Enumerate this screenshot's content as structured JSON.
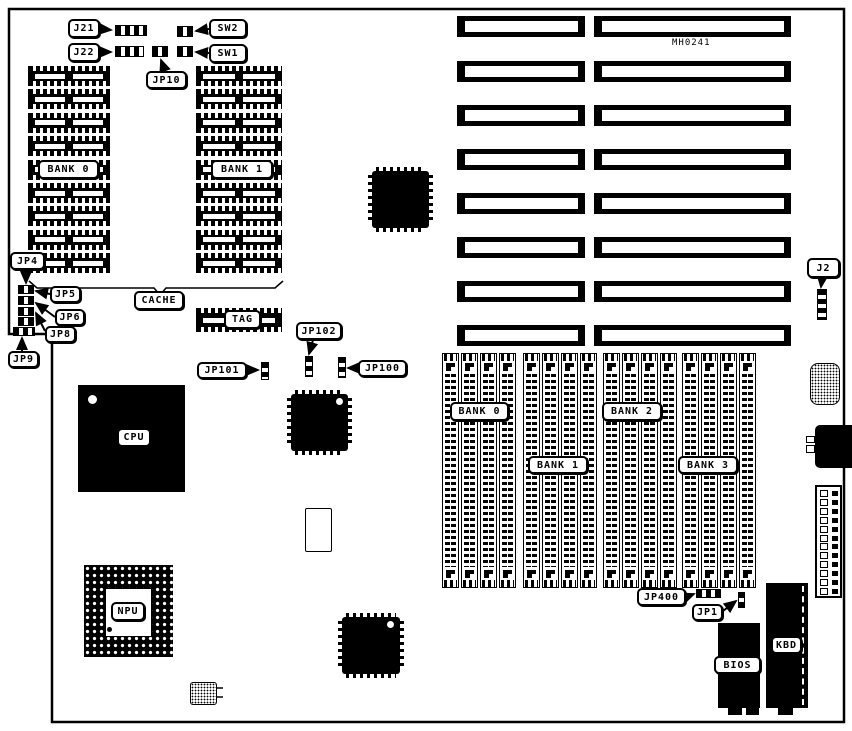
{
  "board": {
    "part_number": "MH0241",
    "labels": {
      "j21": "J21",
      "j22": "J22",
      "sw2": "SW2",
      "sw1": "SW1",
      "jp10": "JP10",
      "jp4": "JP4",
      "jp5": "JP5",
      "jp6": "JP6",
      "jp8": "JP8",
      "jp9": "JP9",
      "cache": "CACHE",
      "tag": "TAG",
      "jp101": "JP101",
      "jp102": "JP102",
      "jp100": "JP100",
      "cpu": "CPU",
      "npu": "NPU",
      "cache_bank_0": "BANK 0",
      "cache_bank_1": "BANK 1",
      "simm_bank_0": "BANK 0",
      "simm_bank_1": "BANK 1",
      "simm_bank_2": "BANK 2",
      "simm_bank_3": "BANK 3",
      "j2": "J2",
      "jp400": "JP400",
      "jp1": "JP1",
      "bios": "BIOS",
      "kbd": "KBD"
    },
    "colors": {
      "ink": "#000000",
      "paper": "#ffffff"
    }
  }
}
